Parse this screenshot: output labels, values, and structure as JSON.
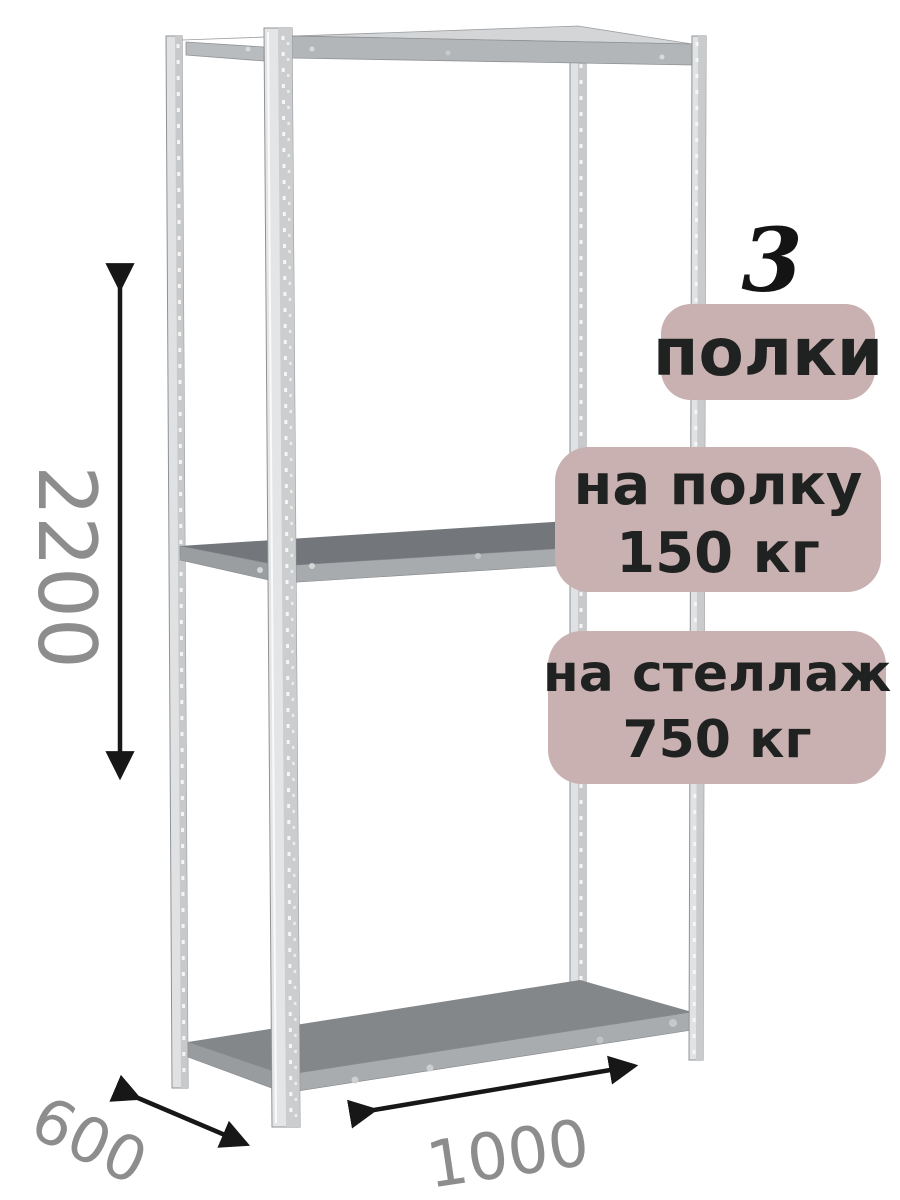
{
  "annotations": {
    "shelf_count": {
      "value": "3",
      "label": "полки"
    },
    "per_shelf": {
      "line1": "на полку",
      "line2": "150 кг"
    },
    "per_rack": {
      "line1": "на стеллаж",
      "line2": "750 кг"
    }
  },
  "dimensions": {
    "height_mm": "2200",
    "depth_mm": "600",
    "width_mm": "1000"
  },
  "colors": {
    "badge-bg": "#c8b1b0",
    "badge-text": "#1f2220",
    "dim-text": "#8d8d8d",
    "arrow": "#171717"
  }
}
